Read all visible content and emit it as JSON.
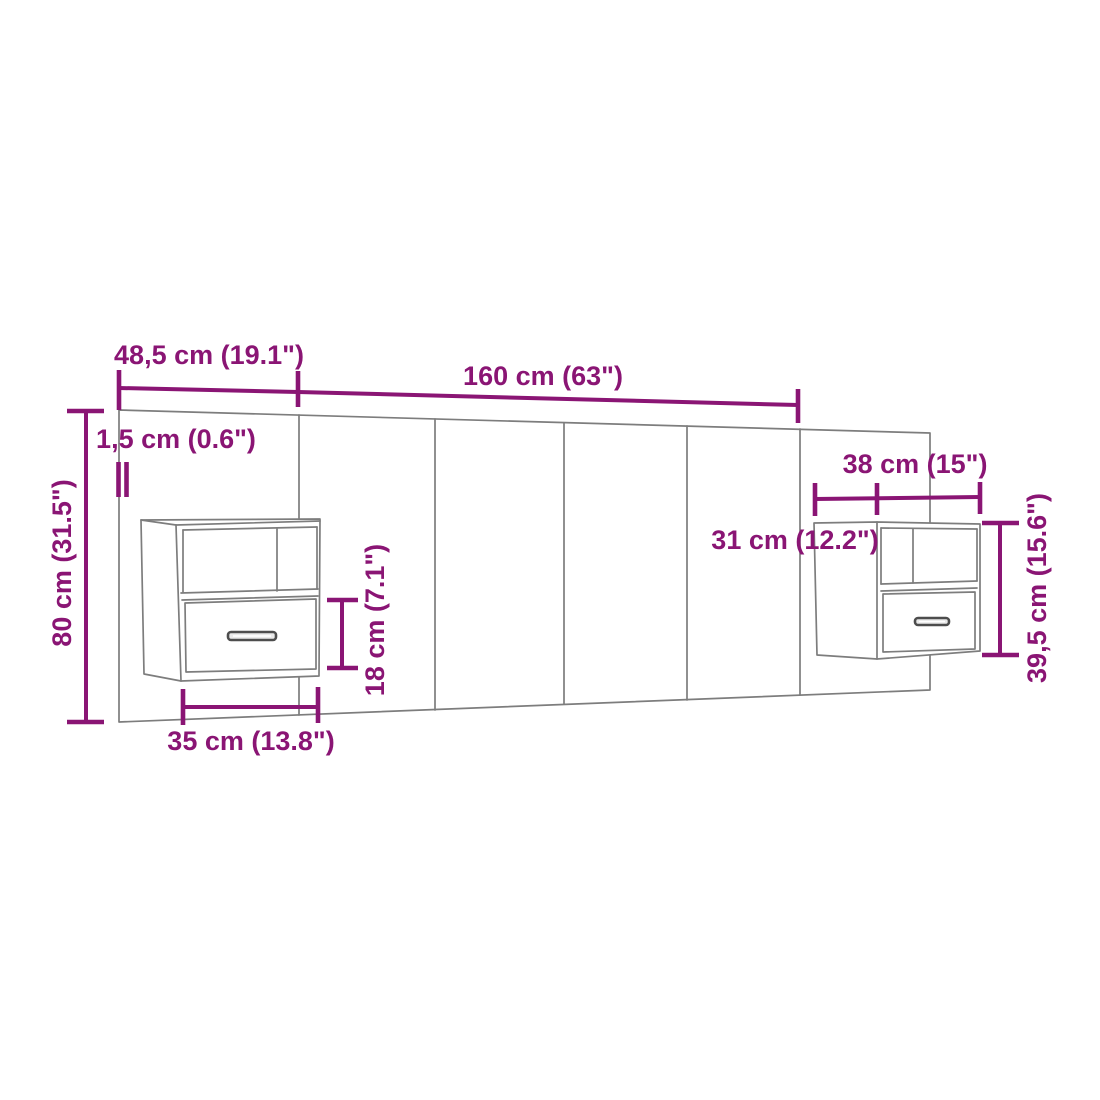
{
  "diagram": {
    "type": "furniture-dimension-drawing",
    "subject": "wall-headboard-with-two-floating-bedside-cabinets",
    "colors": {
      "dimension_accent": "#8A1574",
      "furniture_outline": "#7d7d7d",
      "background": "#ffffff"
    },
    "dimensions": {
      "headboard_side_width": "48,5 cm (19.1\")",
      "headboard_center_width": "160 cm (63\")",
      "panel_thickness": "1,5 cm (0.6\")",
      "headboard_height": "80 cm (31.5\")",
      "left_cabinet_width": "35 cm (13.8\")",
      "drawer_height": "18 cm (7.1\")",
      "right_cabinet_width": "38 cm (15\")",
      "cabinet_depth": "31 cm (12.2\")",
      "right_cabinet_height": "39,5 cm (15.6\")"
    }
  }
}
